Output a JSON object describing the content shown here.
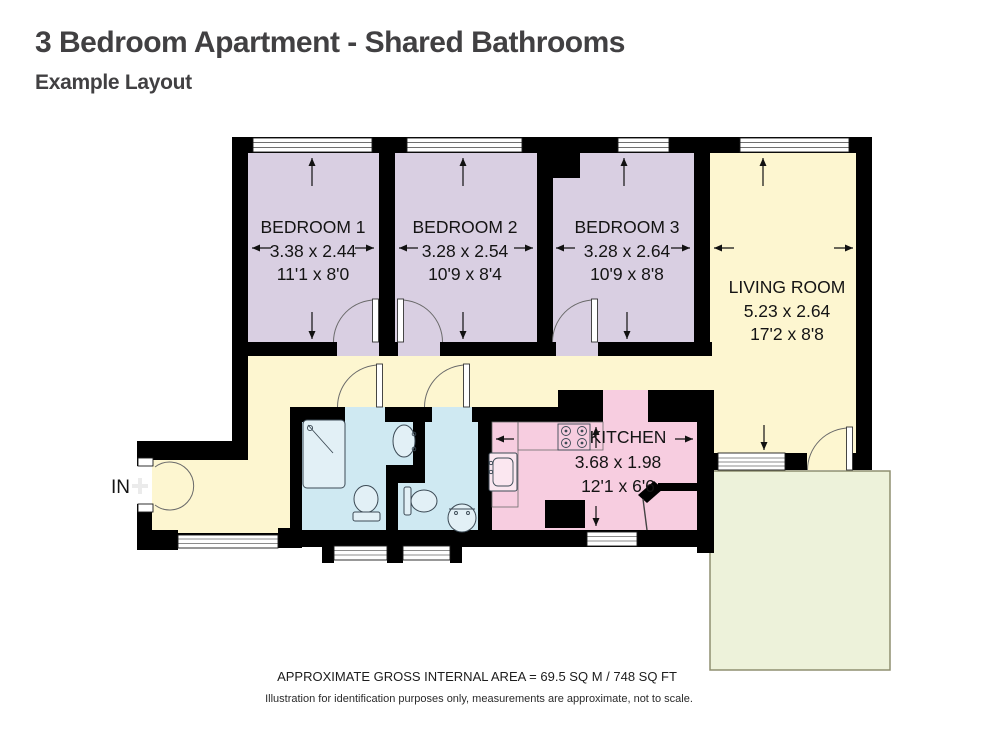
{
  "header": {
    "title": "3 Bedroom Apartment - Shared Bathrooms",
    "subtitle": "Example Layout"
  },
  "entrance": {
    "label": "IN"
  },
  "rooms": {
    "bedroom1": {
      "name": "BEDROOM 1",
      "metric": "3.38 x 2.44",
      "imperial": "11'1 x 8'0"
    },
    "bedroom2": {
      "name": "BEDROOM 2",
      "metric": "3.28 x 2.54",
      "imperial": "10'9 x 8'4"
    },
    "bedroom3": {
      "name": "BEDROOM 3",
      "metric": "3.28 x 2.64",
      "imperial": "10'9 x 8'8"
    },
    "living": {
      "name": "LIVING ROOM",
      "metric": "5.23 x 2.64",
      "imperial": "17'2 x 8'8"
    },
    "kitchen": {
      "name": "KITCHEN",
      "metric": "3.68 x 1.98",
      "imperial": "12'1 x 6'6"
    }
  },
  "footer": {
    "area": "APPROXIMATE GROSS INTERNAL AREA = 69.5 SQ M / 748 SQ FT",
    "disclaimer": "Illustration for identification purposes only, measurements are approximate, not to scale."
  },
  "colors": {
    "wall": "#000000",
    "bedroom": "#d9cfe2",
    "living": "#fdf6d0",
    "bathroom": "#cfe9f2",
    "kitchen": "#f7cde0",
    "balcony": "#edf2da"
  }
}
